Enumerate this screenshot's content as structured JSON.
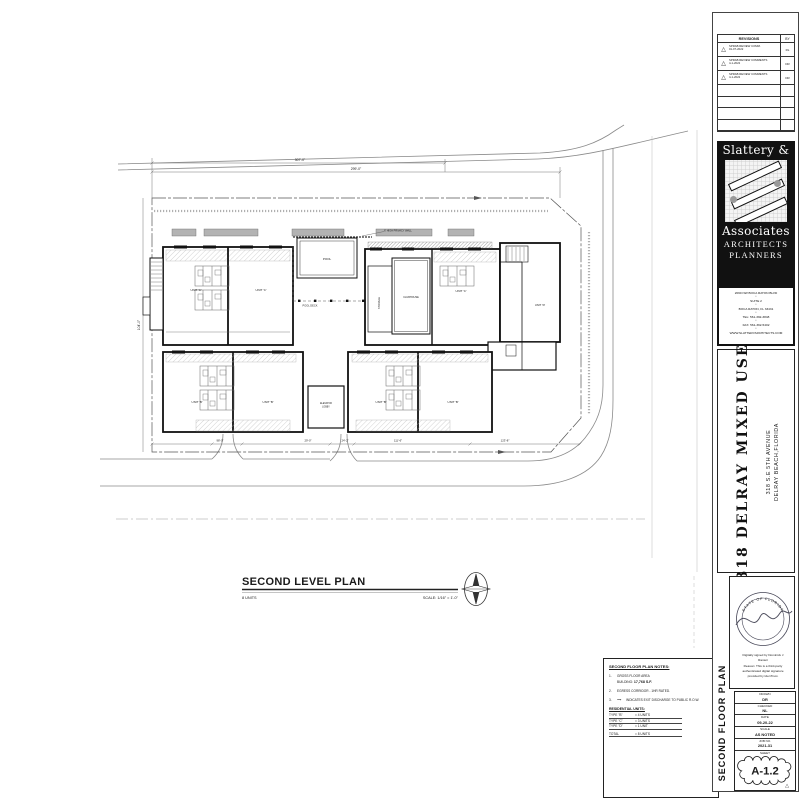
{
  "colors": {
    "ink": "#1a1a1a",
    "road": "#8a8a8a",
    "balcony": "#b3b3b3"
  },
  "revisions": {
    "header": "REVISIONS",
    "by_header": "BY",
    "rows": [
      {
        "no": "1",
        "text": "SPRAB REVIEW COMM.",
        "date": "01-07-2022",
        "by": "RL"
      },
      {
        "no": "2",
        "text": "SPRAB REVIEW COMMENTS",
        "date": "4-1-2022",
        "by": "DR"
      },
      {
        "no": "3",
        "text": "SPRAB REVIEW COMMENTS",
        "date": "4-1-2022",
        "by": "DR"
      }
    ]
  },
  "firm": {
    "name_line1": "Slattery &",
    "name_line2": "Associates",
    "discipline1": "ARCHITECTS",
    "discipline2": "PLANNERS",
    "bullet": "•",
    "address": [
      "2060 NW BOCA RATON BLVD",
      "SUITE 2",
      "BOCA RATON, FL 33431",
      "TEL: 561-392-3848",
      "FAX: 561-392-5402",
      "WWW.SLATTERYARCHITECTS.COM"
    ]
  },
  "project": {
    "title": "318 DELRAY MIXED USE",
    "address_line1": "318 S.E 5TH AVENUE",
    "address_line2": "DELRAY BEACH,FLORIDA"
  },
  "seal": {
    "arc_text": "STATE OF FLORIDA",
    "cert_lines": [
      "Digitally signed by Dominick J",
      "Ranieri",
      "Reason: This is a third-party",
      "authenticated digital signature",
      "provided by IdenTrust."
    ]
  },
  "titleblock": {
    "vertical_title": "SECOND FLOOR PLAN",
    "drawn_label": "DRAWN",
    "drawn": "DR",
    "checked_label": "CHECKED",
    "checked": "NL",
    "date_label": "DATE",
    "date": "09-20-22",
    "scale_label": "SCALE",
    "scale": "AS NOTED",
    "job_label": "JOB NO.",
    "job": "2021-31",
    "sheet_label": "SHEET",
    "sheet_number": "A-1.2"
  },
  "plan": {
    "title": "SECOND LEVEL PLAN",
    "units_note": "8 UNITS",
    "scale_note": "SCALE: 1/16\" = 1'-0\"",
    "labels": {
      "pool": "POOL",
      "pool_deck": "POOL DECK",
      "clubhouse": "CLUBHOUSE",
      "storage": "STORAGE",
      "elevator": "ELEVATOR",
      "lobby": "LOBBY",
      "privacy_wall": "6' HIGH PRIVACY WALL"
    },
    "unit_labels": [
      "UNIT 'C'",
      "UNIT 'C'",
      "UNIT 'C'",
      "UNIT 'D'",
      "UNIT 'B'",
      "UNIT 'B'",
      "UNIT 'B'",
      "UNIT 'B'"
    ],
    "dims": {
      "top_outer": "307'-0\"",
      "top_inner": "299'-0\"",
      "left": "104'-0\"",
      "bottom": [
        "98'-0\"",
        "29'-0\"",
        "24'-2\"",
        "111'-6\"",
        "123'-8\""
      ]
    }
  },
  "notes": {
    "title": "SECOND FLOOR PLAN NOTES:",
    "item1_no": "1.",
    "item1_text": "GROSS FLOOR AREA",
    "item1b_label": "BUILDING:",
    "item1b_value": "17,768 S.F.",
    "item2_no": "2.",
    "item2_text": "EGRESS CORRIDOR - 1HR RATED.",
    "item3_no": "3.",
    "item3_arrow": "⟶",
    "item3_text": "INDICATES EXIT DISCHARGE TO PUBLIC R.O.W.",
    "res_title": "RESIDENTIAL UNITS:",
    "res_rows": [
      {
        "type": "TYPE \"B\"",
        "qty": "= 4 UNITS"
      },
      {
        "type": "TYPE \"C\"",
        "qty": "= 3 UNITS"
      },
      {
        "type": "TYPE \"D\"",
        "qty": "= 1 UNIT"
      },
      {
        "type": "TOTAL",
        "qty": "= 8 UNITS"
      }
    ]
  }
}
